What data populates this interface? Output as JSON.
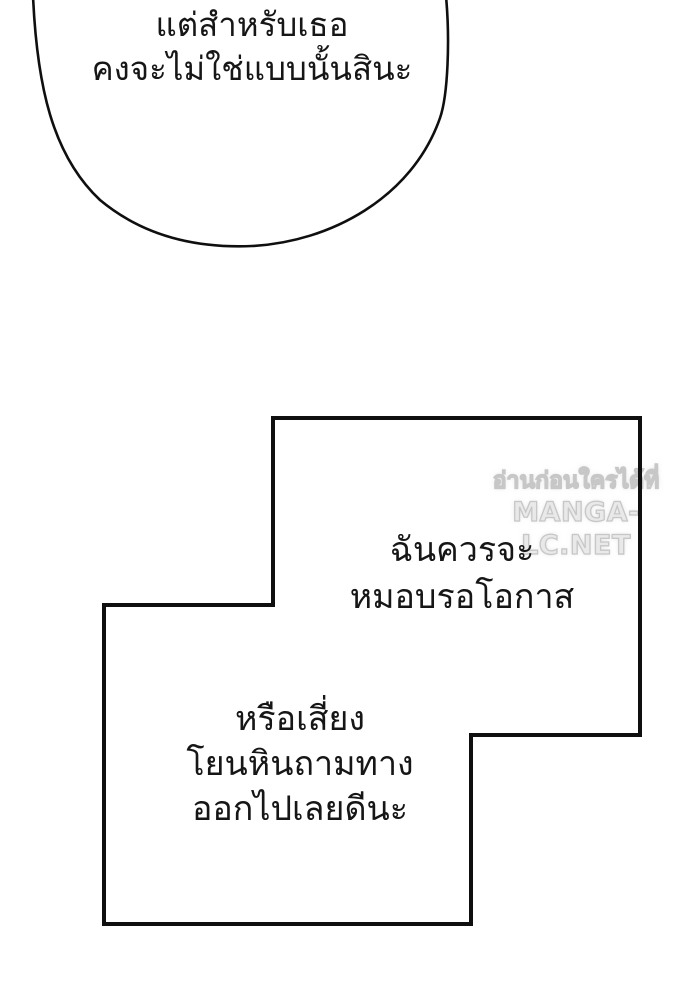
{
  "page": {
    "background_color": "#ffffff",
    "line_color": "#0f0f0f"
  },
  "speech_bubble": {
    "text": "แต่สำหรับเธอ\nคงจะไม่ใช่แบบนั้นสินะ"
  },
  "thought_box": {
    "upper_text": "ฉันควรจะ\nหมอบรอโอกาส",
    "lower_text": "หรือเสี่ยง\nโยนหินถามทาง\nออกไปเลยดีนะ"
  },
  "watermark": {
    "line1": "อ่านก่อนใครได้ที่",
    "line2": "MANGA-LC.NET",
    "color": "#e9e9e9"
  }
}
